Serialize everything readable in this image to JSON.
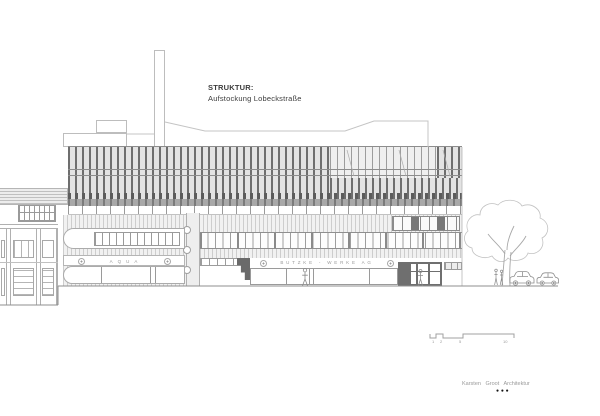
{
  "annotation": {
    "title": "STRUKTUR:",
    "subtitle": "Aufstockung Lobeckstraße"
  },
  "building_signs": {
    "aqua": "AQUA",
    "butzke_werke": "BUTZKE - WERKE AG"
  },
  "scale_bar": {
    "labels": [
      "1",
      "2",
      "5",
      "10"
    ]
  },
  "credit": {
    "firm": "Karsten Groot Architektur",
    "dots": "●●●"
  },
  "colors": {
    "fin_dark": "#6e6e6e",
    "facade_light": "#e3e3e3",
    "linework": "#b8b8b8",
    "sign_text": "#9a9a9a",
    "canopy_dark": "#6a6a6a"
  }
}
